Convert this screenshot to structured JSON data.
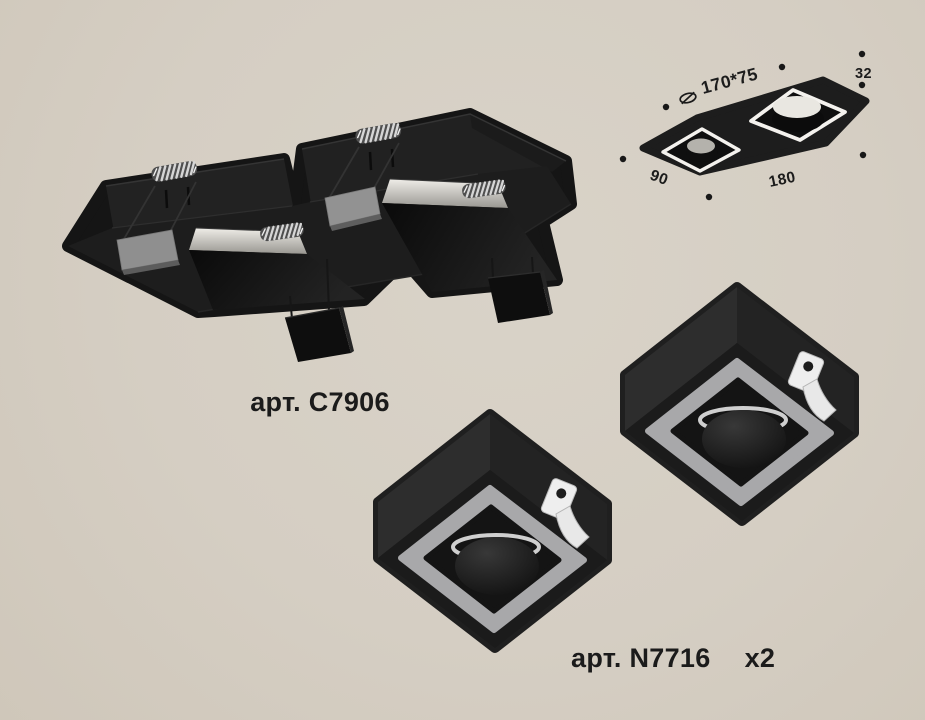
{
  "page": {
    "background_color": "#d5cec3",
    "description_icons": [
      "diameter-icon",
      "mounting-spring-icon",
      "spring-clip-icon"
    ]
  },
  "products": {
    "housing": {
      "article_label": "арт. C7906"
    },
    "insert": {
      "article_label": "арт. N7716",
      "quantity_label": "x2"
    }
  },
  "dimension_diagram": {
    "cutout_size": "170*75",
    "height_mm": "32",
    "width_mm": "90",
    "length_mm": "180",
    "icon": "diameter-icon",
    "dot_count": 7
  },
  "colors": {
    "fixture_black": "#151515",
    "trim_ring_gray": "#a8a8aa",
    "retainer_gray": "#8f8f8f",
    "spring_silver": "#d6d6d6",
    "clip_white": "#eeeeee",
    "text": "#1c1c1c"
  }
}
